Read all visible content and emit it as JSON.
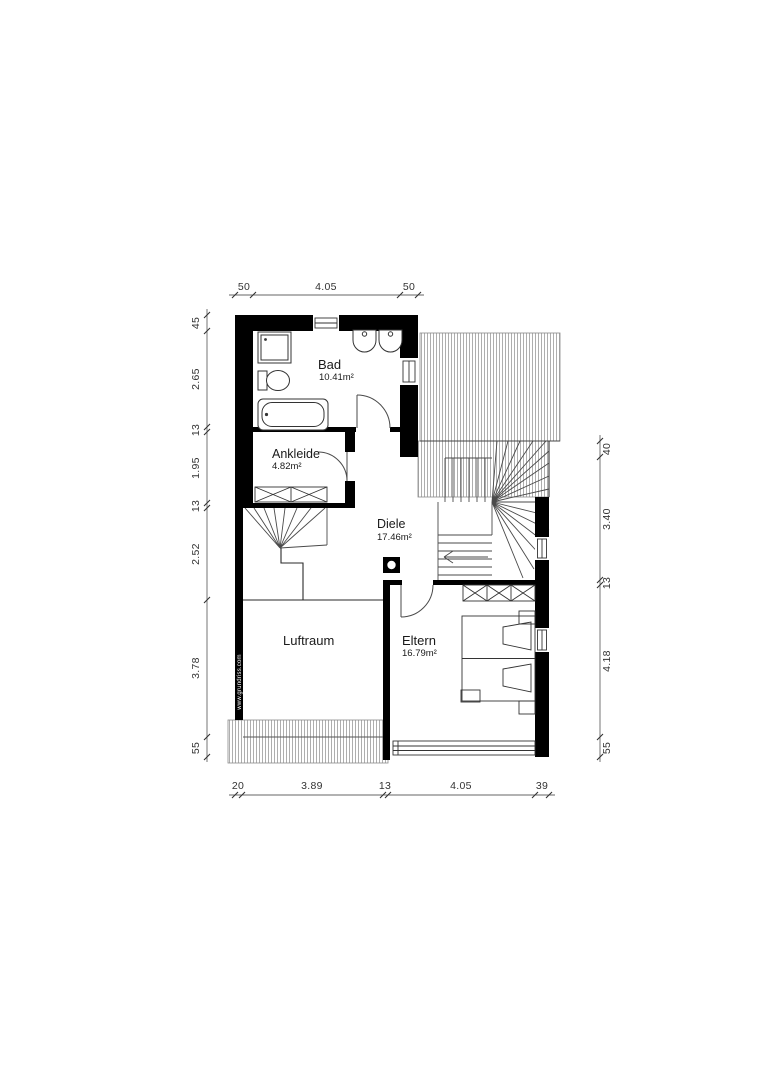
{
  "watermark": "www.grundriss.com",
  "rooms": {
    "bad": {
      "name": "Bad",
      "area": "10.41m²"
    },
    "ankleide": {
      "name": "Ankleide",
      "area": "4.82m²"
    },
    "diele": {
      "name": "Diele",
      "area": "17.46m²"
    },
    "luftraum": {
      "name": "Luftraum"
    },
    "eltern": {
      "name": "Eltern",
      "area": "16.79m²"
    }
  },
  "dimensions": {
    "top": [
      "50",
      "4.05",
      "50"
    ],
    "left": [
      "45",
      "2.65",
      "13",
      "1.95",
      "13",
      "2.52",
      "3.78",
      "55"
    ],
    "right": [
      "40",
      "3.40",
      "13",
      "4.18",
      "55"
    ],
    "bottom": [
      "20",
      "3.89",
      "13",
      "4.05",
      "39"
    ]
  },
  "colors": {
    "wall": "#000000",
    "hatch": "#9a9a9a",
    "dimension_text": "#333333"
  }
}
